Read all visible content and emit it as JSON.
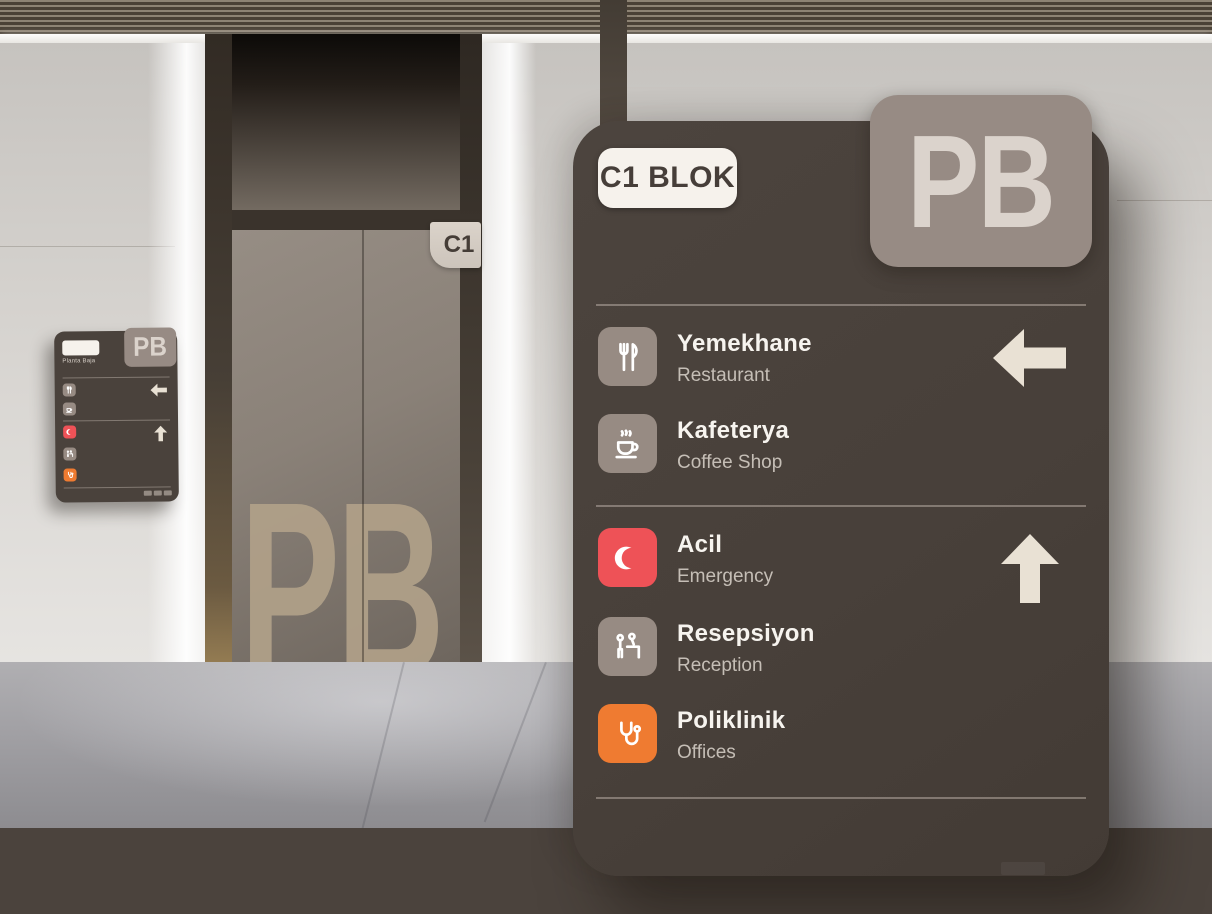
{
  "colors": {
    "panel-bg": "#48403a",
    "tile-neutral": "#978b83",
    "accent-red": "#ee5257",
    "accent-orange": "#ef7b31",
    "arrow-cream": "#e9e1d4",
    "badge-bg": "#978b84",
    "badge-text": "#dbd3cc",
    "pill-bg": "#f6f2ec",
    "pill-text": "#463e39",
    "title-text": "#f7f4ef",
    "subtitle-text": "#c5beb6"
  },
  "scene": {
    "elevator_flag_label": "C1",
    "door_letters": "PB"
  },
  "panel": {
    "block_label": "C1 BLOK",
    "floor_code": "PB",
    "sections": [
      {
        "direction_icon": "arrow-left-icon",
        "items": [
          {
            "icon": "fork-knife-icon",
            "title": "Yemekhane",
            "subtitle": "Restaurant",
            "tile": "neutral"
          },
          {
            "icon": "coffee-cup-icon",
            "title": "Kafeterya",
            "subtitle": "Coffee Shop",
            "tile": "neutral"
          }
        ]
      },
      {
        "direction_icon": "arrow-up-icon",
        "items": [
          {
            "icon": "crescent-icon",
            "title": "Acil",
            "subtitle": "Emergency",
            "tile": "red"
          },
          {
            "icon": "reception-icon",
            "title": "Resepsiyon",
            "subtitle": "Reception",
            "tile": "neutral"
          },
          {
            "icon": "stethoscope-icon",
            "title": "Poliklinik",
            "subtitle": "Offices",
            "tile": "orange"
          }
        ]
      }
    ]
  },
  "wall_sign": {
    "floor_code": "PB",
    "floor_name": "Planta Baja"
  }
}
